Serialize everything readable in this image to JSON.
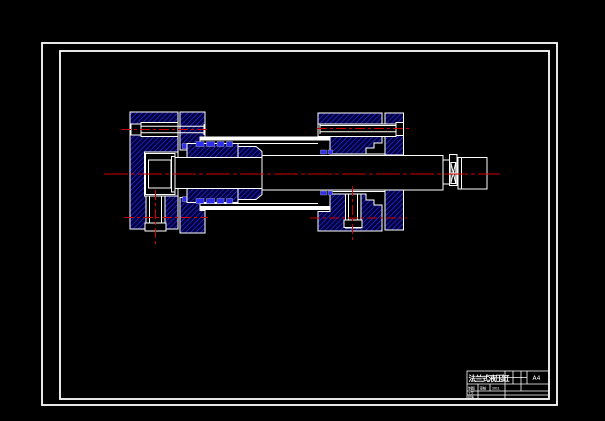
{
  "colors": {
    "line": "#ffffff",
    "centerline": "#cc0000",
    "hatch_bg": "#000042",
    "hatch_line": "#3434e0",
    "seal": "#2d2df0",
    "bg": "#000000"
  },
  "title_block": {
    "title": "法兰式液压缸",
    "sheet_size": "A4",
    "row2": [
      "制图",
      "审核",
      "2011"
    ],
    "row3": [
      "工艺"
    ],
    "row4": [
      "批准"
    ]
  }
}
